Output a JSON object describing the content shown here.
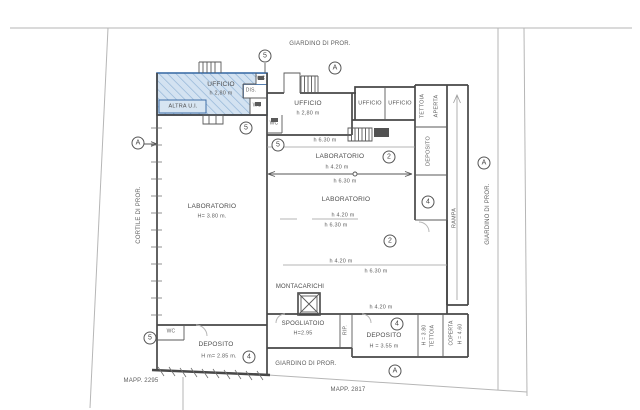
{
  "drawing": {
    "kind": "architectural floor plan",
    "parcels": {
      "left": "MAPP. 2295",
      "bottom": "MAPP. 2817"
    },
    "surroundings": {
      "garden_top": "GIARDINO DI PROR.",
      "garden_right": "GIARDINO DI PROR.",
      "garden_bottom": "GIARDINO DI PROR.",
      "courtyard_left": "CORTILE DI PROR."
    },
    "unit": {
      "tag": "ALTRA U.I.",
      "ufficio": "UFFICIO",
      "ufficio_h": "h 2,80 m",
      "dis": "DIS.",
      "wc": "WC"
    },
    "rooms": {
      "ufficio": "UFFICIO",
      "ufficio_h": "h 2,80 m",
      "wc": "WC",
      "laboratorio": "LABORATORIO",
      "laboratorio_h": "H= 3.80 m.",
      "montacarichi": "MONTACARICHI",
      "spogliatoio": "SPOGLIATOIO",
      "spogliatoio_h": "H=2.95",
      "rip": "RIP.",
      "deposito": "DEPOSITO",
      "deposito_right_h": "H = 3.55 m",
      "deposito_left_h": "H m= 2.85 m.",
      "tettoia": "TETTOIA",
      "aperta": "APERTA",
      "rampa": "RAMPA",
      "tettoia_h": "H = 3.80",
      "coperta": "COPERTA",
      "coperta_h": "H = 4.60"
    },
    "heights": {
      "h420": "h 4.20 m",
      "h630": "h 6.30 m"
    },
    "markers": {
      "a": "A",
      "n2": "2",
      "n4": "4",
      "n5": "5"
    },
    "colors": {
      "highlight_fill": "#d3e2f1",
      "highlight_border": "#3f6fa8",
      "wall": "#474747"
    }
  }
}
